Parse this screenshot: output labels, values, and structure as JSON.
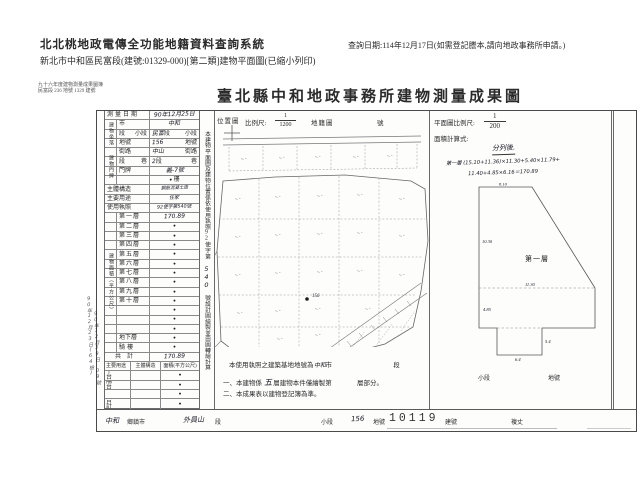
{
  "system_header": {
    "title": "北北桃地政電傳全功能地籍資料查詢系統",
    "subtitle": "新北市中和區民富段(建號:01329-000)[第二類]建物平面圖(已縮小列印)",
    "query_date": "查詢日期:114年12月17日(如需登記謄本,請向地政事務所申請。)"
  },
  "sheet": {
    "corner_note_line1": "九十六年度建物測量成果圖簿",
    "corner_note_line2": "民富段 236 地號 1329 建號",
    "title": "臺北縣中和地政事務所建物測量成果圖",
    "form": {
      "survey_date_label": "測量日期",
      "survey_date_value": "90年12月25日",
      "location_group_label": "建物坐落",
      "city_label": "市",
      "city_value": "中和",
      "section_label": "段",
      "subsection_label": "小段",
      "section_value": "民富",
      "parcel_label": "地號",
      "parcel_value": "156",
      "door_group_label": "建物門牌",
      "street_label": "街路",
      "street_value": "中山",
      "lane_label": "段",
      "lane_suffix": "巷",
      "lane_value": "2",
      "door_label": "門牌",
      "door_value": "義-7號",
      "floor_suffix_dot": "●",
      "floor_suffix": "樓",
      "structure_label": "主體構造",
      "structure_value": "鋼筋混凝土造",
      "usage_label": "主要用途",
      "usage_value": "住家",
      "license_label": "使用執照",
      "license_value": "92使字第540號",
      "area_group_label": "建物面積（平方公尺）",
      "floors": [
        {
          "label": "第一層",
          "value": "170.89"
        },
        {
          "label": "第二層",
          "value": "●"
        },
        {
          "label": "第三層",
          "value": "●"
        },
        {
          "label": "第四層",
          "value": "●"
        },
        {
          "label": "第五層",
          "value": "●"
        },
        {
          "label": "第六層",
          "value": "●"
        },
        {
          "label": "第七層",
          "value": "●"
        },
        {
          "label": "第八層",
          "value": "●"
        },
        {
          "label": "第九層",
          "value": "●"
        },
        {
          "label": "第十層",
          "value": "●"
        },
        {
          "label": "",
          "value": "●"
        },
        {
          "label": "",
          "value": "●"
        },
        {
          "label": "",
          "value": "●"
        },
        {
          "label": "地下層",
          "value": "●"
        },
        {
          "label": "騎樓",
          "value": "●"
        }
      ],
      "total_label": "共計",
      "total_value": "170.89",
      "annex_header": {
        "c1": "主要用途",
        "c2": "主體構造",
        "c3": "面積(平方公尺)"
      },
      "annex_rows": [
        {
          "label": "平台",
          "value": "●"
        },
        {
          "label": "陽台",
          "value": "●"
        },
        {
          "label": "",
          "value": "●"
        },
        {
          "label": "合計",
          "value": "●"
        }
      ],
      "margin_note1": "90年12月23日(64檢)",
      "margin_note2": "90年12月29日 09號"
    },
    "vertical_strip": {
      "text_before": "本建物平面圖及建物位置係依使用執照92使字第",
      "hand_value": "540",
      "text_after": "號設計圖繪製並由圖轉繪計算"
    },
    "map_panel": {
      "location_label": "位置圖",
      "scale_label": "比例尺:",
      "scale_num": "1",
      "scale_den": "1200",
      "cadastre_label": "地籍圖",
      "number_label": "號",
      "subject_parcel": "156",
      "note1_prefix": "本使用執照之建築基地地號為",
      "note1_city": "中和",
      "note1_city_suffix": "市",
      "note1_tail": "段",
      "note2_prefix": "一、本建物係",
      "note2_floors": "五",
      "note2_mid": "層建物本件僅繪製第",
      "note2_tail": "層部分。",
      "note3": "二、本成果表以建物登記簿為準。"
    },
    "plan_panel": {
      "scale_label": "平面圖比例尺:",
      "scale_num": "1",
      "scale_den": "200",
      "formula_label": "面積計算式:",
      "formula_note": "分列後.",
      "formula_line1": "第一層 (15.10+11.36)×11.30+5.40×11.79+",
      "formula_line2": "11.40+4.85×6.16＝170.89",
      "floor_label": "第一層",
      "dims": {
        "top": "8.10",
        "left": "10.30",
        "mid": "11.30",
        "lower_left": "4.85",
        "notch_right": "5.4",
        "notch_bottom": "6.4"
      },
      "sub_subsection": "小段",
      "sub_parcel": "地號"
    },
    "bottom_strip": {
      "township_value": "中和",
      "township_label": "鄉鎮市",
      "section_value": "外員山",
      "section_label": "段",
      "subsection_label": "小段",
      "parcel_value": "156",
      "parcel_label": "地號",
      "building_no_stamp": "10119",
      "building_no_label": "建號",
      "survey_label": "複丈"
    }
  }
}
